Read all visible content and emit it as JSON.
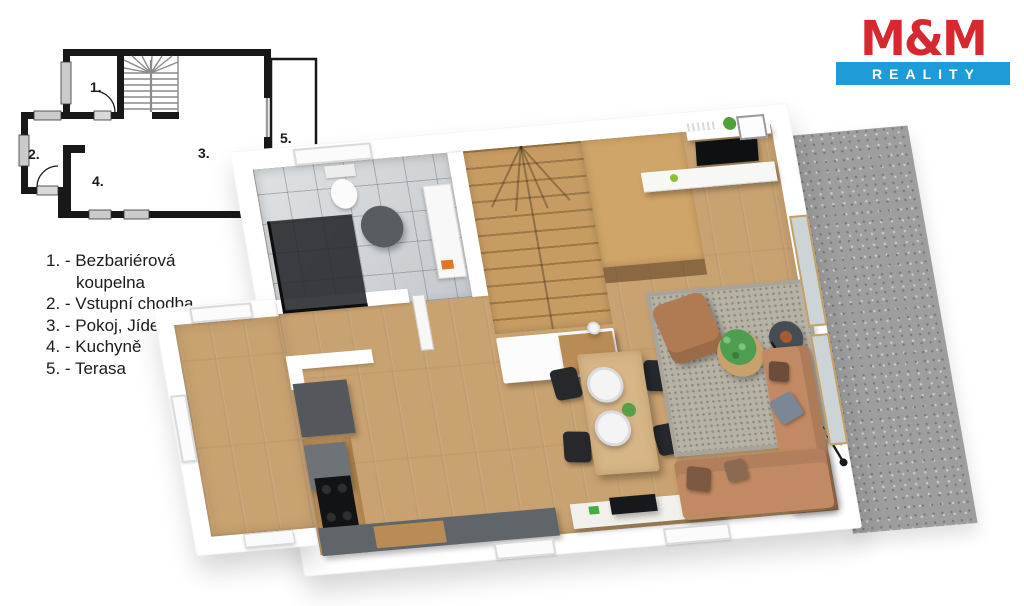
{
  "logo": {
    "title": "M&M",
    "subtitle": "REALITY",
    "title_color": "#d7282f",
    "bar_color": "#1e9cd7"
  },
  "legend": {
    "items": [
      {
        "text": "1. - Bezbariérová",
        "text2": "koupelna"
      },
      {
        "text": "2. - Vstupní chodba"
      },
      {
        "text": "3. - Pokoj, Jídelna"
      },
      {
        "text": "4. - Kuchyně"
      },
      {
        "text": "5. - Terasa"
      }
    ]
  },
  "plan2d": {
    "room_numbers": [
      "1.",
      "2.",
      "3.",
      "4.",
      "5."
    ]
  },
  "colors": {
    "wall_white": "#ffffff",
    "plan_line": "#181818",
    "floor_wood": "#c9a271",
    "stairs_wood": "#c79c63",
    "bathroom_tile": "#d3d6d9",
    "kitchen_gray": "#5f6468",
    "counter_wood": "#b98c55",
    "sofa_tan": "#c28a64",
    "rug_gray": "#b7b2a6",
    "terrace_gravel": "#9e9e9e"
  }
}
